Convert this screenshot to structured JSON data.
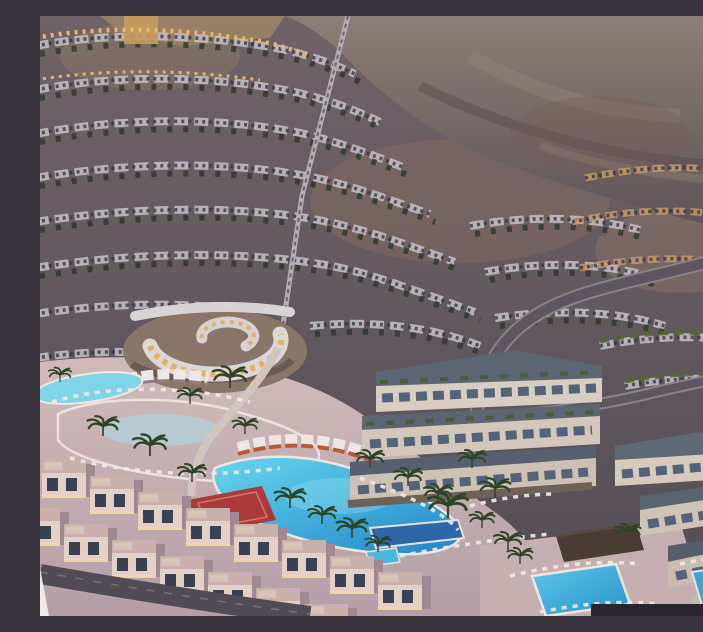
{
  "scene": {
    "title": "Twilight aerial 3D rendering of a terraced hillside resort community",
    "description": "Masterplan render at dusk: curved rows of terraced villas climb a desert mountainside beneath a hazy rock ridge; a funicular track runs down the slope to a spiral clubhouse with warmly lit windows. Below, lagoon-style swimming pools in bright cyan are edged by palm trees, sun loungers and cabanas, with a red sports court, a navy infinity pool, modern cube apartment terraces, winding grey roads, beachfront villa rows with glowing facades, and a rectangular pool at lower right. A dark rectangular panel edge overlaps the bottom-right corner of the frame.",
    "time_of_day": "dusk",
    "landmarks": [
      {
        "label": "mountain-backdrop"
      },
      {
        "label": "terraced-villa-rows"
      },
      {
        "label": "funicular-track"
      },
      {
        "label": "spiral-clubhouse"
      },
      {
        "label": "lagoon-pool-upper"
      },
      {
        "label": "lagoon-pool-lower"
      },
      {
        "label": "pedestrian-bridge"
      },
      {
        "label": "red-sports-court"
      },
      {
        "label": "cabana-row"
      },
      {
        "label": "apartment-terraces"
      },
      {
        "label": "cube-apartments-right"
      },
      {
        "label": "beachfront-villas"
      },
      {
        "label": "rectangular-pool"
      },
      {
        "label": "navy-infinity-pool"
      },
      {
        "label": "palm-trees"
      },
      {
        "label": "bottom-right-dark-panel"
      }
    ]
  },
  "palette": {
    "mountain": "#8d7e76",
    "mountain_shadow": "#5c5256",
    "hillside": "#6f6368",
    "hillside_dark": "#544d55",
    "villa_band": "#c3bcc0",
    "window_dark": "#333847",
    "tree_green": "#2b3a27",
    "warm_light": "#e8bb6c",
    "road": "#5d5660",
    "road_edge": "#8b8288",
    "deck": "#cdb7b8",
    "pool_bright": "#66d6ee",
    "pool_deep": "#1f86c6",
    "pool_navy": "#2e66aa",
    "court_red": "#aa3a3c",
    "clubhouse_roof": "#dcd8da",
    "clubhouse_glow": "#e8ad52",
    "apartment_wall": "#d7cdc0",
    "apartment_roof": "#5c6572",
    "green_roof": "#4a5a32",
    "villa_wall": "#e4d0c4",
    "villa_light": "#f0d8a2",
    "dark_panel": "#26262c"
  }
}
